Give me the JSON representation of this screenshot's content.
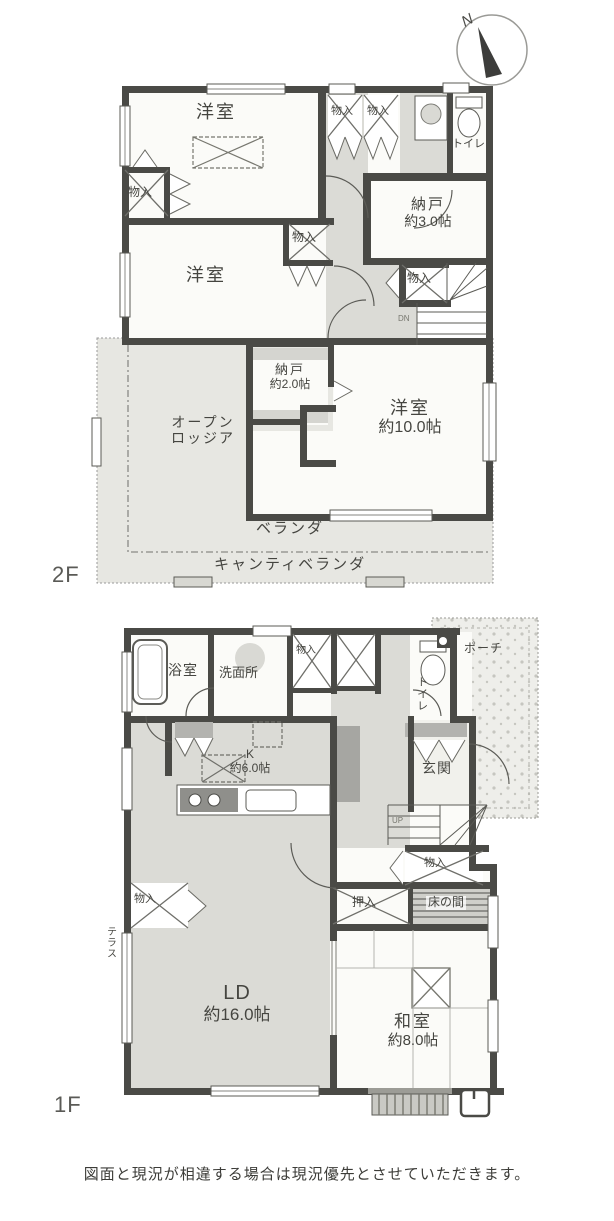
{
  "compass": {
    "north": "N"
  },
  "floor2": {
    "floor_label": "2F",
    "labels": {
      "yoshitsu1": "洋室",
      "closet_left": "物入",
      "closet_top_a": "物入",
      "closet_top_b": "物入",
      "toilet": "トイレ",
      "nando3_line1": "納戸",
      "nando3_line2": "約3.0帖",
      "closet_mid": "物入",
      "yoshitsu2": "洋室",
      "closet_stairs": "物入",
      "stairs_dn": "DN",
      "nando2_line1": "納戸",
      "nando2_line2": "約2.0帖",
      "loggia_line1": "オープン",
      "loggia_line2": "ロッジア",
      "yoshitsu10_line1": "洋室",
      "yoshitsu10_line2": "約10.0帖",
      "veranda": "ベランダ",
      "cantilever_veranda": "キャンティベランダ"
    }
  },
  "floor1": {
    "floor_label": "1F",
    "labels": {
      "bath": "浴室",
      "washroom": "洗面所",
      "closet_top": "物入",
      "toilet": "トイレ",
      "porch": "ポーチ",
      "entrance": "玄関",
      "stairs_up": "UP",
      "closet_under_stairs": "物入",
      "oshiire": "押入",
      "tokonoma": "床の間",
      "kitchen_line1": "K",
      "kitchen_line2": "約6.0帖",
      "ld_line1": "LD",
      "ld_line2": "約16.0帖",
      "closet_ld": "物入",
      "terrace": "テラス",
      "washitsu_line1": "和室",
      "washitsu_line2": "約8.0帖"
    }
  },
  "footer": {
    "disclaimer": "図面と現況が相違する場合は現況優先とさせていただきます。"
  },
  "colors": {
    "wall": "#4a4a46",
    "floor_gray": "#dbdbd6",
    "accent": "#8f8f8b"
  }
}
